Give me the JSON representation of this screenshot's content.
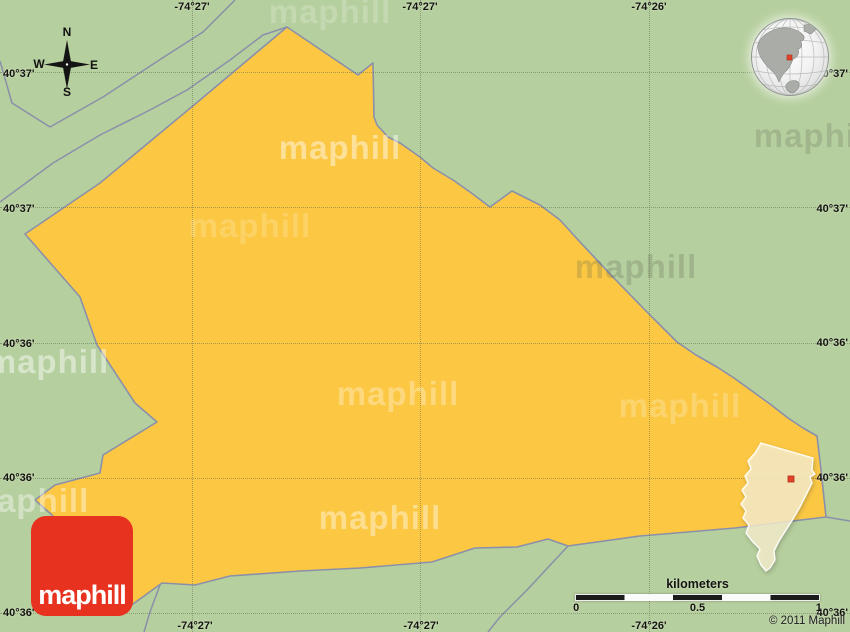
{
  "colors": {
    "green": "#b6cf9e",
    "yellow": "#fcc844",
    "line": "#8a90aa",
    "grid": "rgba(95,105,70,0.5)",
    "logo-red": "#e6321f",
    "marker-red": "#e2422a"
  },
  "logo": {
    "text": "maphill"
  },
  "copyright": "© 2011 Maphill",
  "watermark_text": "maphill",
  "compass": {
    "n": "N",
    "e": "E",
    "s": "S",
    "w": "W"
  },
  "scalebar": {
    "title": "kilometers",
    "ticks": [
      "0",
      "0.5",
      "1"
    ]
  },
  "grid": {
    "top_labels": [
      {
        "text": "-74°27'",
        "x": 192
      },
      {
        "text": "-74°27'",
        "x": 420
      },
      {
        "text": "-74°26'",
        "x": 649
      }
    ],
    "bottom_labels": [
      {
        "text": "-74°27'",
        "x": 195
      },
      {
        "text": "-74°27'",
        "x": 421
      },
      {
        "text": "-74°26'",
        "x": 649
      }
    ],
    "left_labels": [
      {
        "text": "40°37'",
        "y": 74
      },
      {
        "text": "40°37'",
        "y": 209
      },
      {
        "text": "40°36'",
        "y": 344
      },
      {
        "text": "40°36'",
        "y": 478
      },
      {
        "text": "40°36'",
        "y": 613
      }
    ],
    "right_labels": [
      {
        "text": "40°37'",
        "y": 74
      },
      {
        "text": "40°37'",
        "y": 209
      },
      {
        "text": "40°36'",
        "y": 343
      },
      {
        "text": "40°36'",
        "y": 478
      },
      {
        "text": "40°36'",
        "y": 613
      }
    ],
    "h_lines": [
      72,
      207,
      343,
      478,
      613
    ],
    "v_lines": [
      192,
      420,
      649
    ]
  },
  "watermarks": [
    {
      "x": 330,
      "y": 12,
      "tone": "white",
      "opacity": 0.2
    },
    {
      "x": 340,
      "y": 148,
      "tone": "white",
      "opacity": 0.45
    },
    {
      "x": 250,
      "y": 226,
      "tone": "white",
      "opacity": 0.18
    },
    {
      "x": 636,
      "y": 267,
      "tone": "gray",
      "opacity": 0.22
    },
    {
      "x": 48,
      "y": 362,
      "tone": "white",
      "opacity": 0.45
    },
    {
      "x": 398,
      "y": 394,
      "tone": "white",
      "opacity": 0.3
    },
    {
      "x": 680,
      "y": 406,
      "tone": "white",
      "opacity": 0.22
    },
    {
      "x": 815,
      "y": 136,
      "tone": "gray",
      "opacity": 0.2
    },
    {
      "x": 28,
      "y": 501,
      "tone": "white",
      "opacity": 0.4
    },
    {
      "x": 380,
      "y": 518,
      "tone": "white",
      "opacity": 0.4
    }
  ]
}
